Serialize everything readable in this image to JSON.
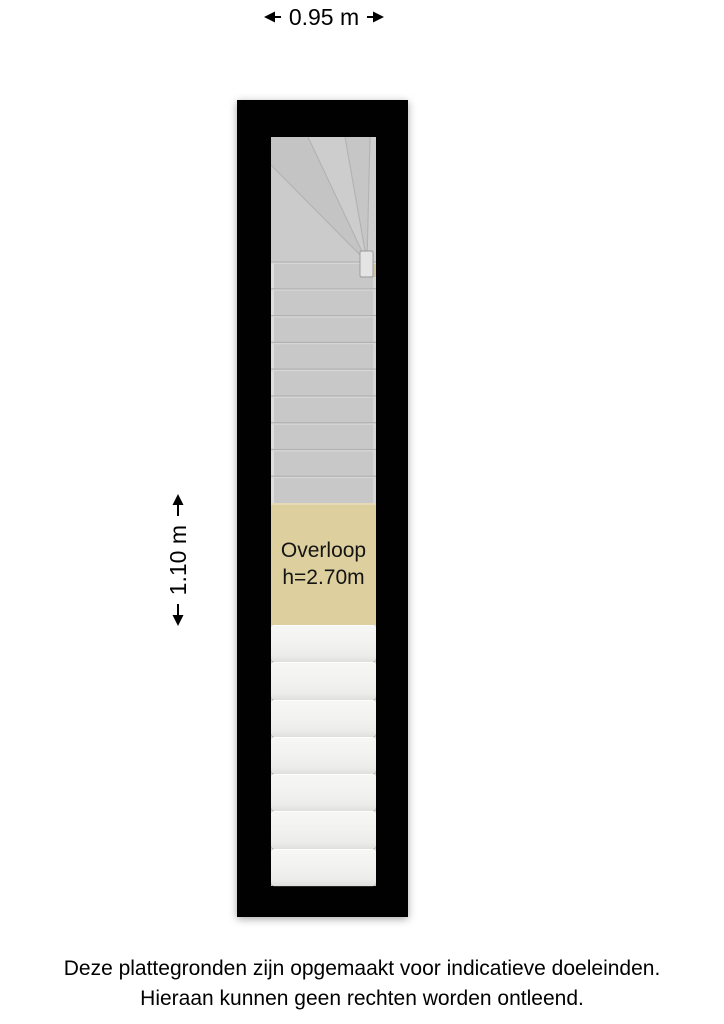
{
  "dimensions": {
    "width_label": "0.95 m",
    "height_label": "1.10 m"
  },
  "floorplan": {
    "room_label": "Overloop",
    "room_height_label": "h=2.70m",
    "upper_straight_step_count": 9,
    "winder_step_count": 5,
    "lower_step_count": 7,
    "colors": {
      "wall": "#010101",
      "upper_stairs": "#c8c8c8",
      "stair_line": "#b2b2b2",
      "stair_highlight": "#d9d9d9",
      "landing": "#ddcf9e",
      "lower_stairs": "#f1f1f0"
    }
  },
  "disclaimer": {
    "line1": "Deze plattegronden zijn opgemaakt voor indicatieve doeleinden.",
    "line2": "Hieraan kunnen geen rechten worden ontleend."
  }
}
